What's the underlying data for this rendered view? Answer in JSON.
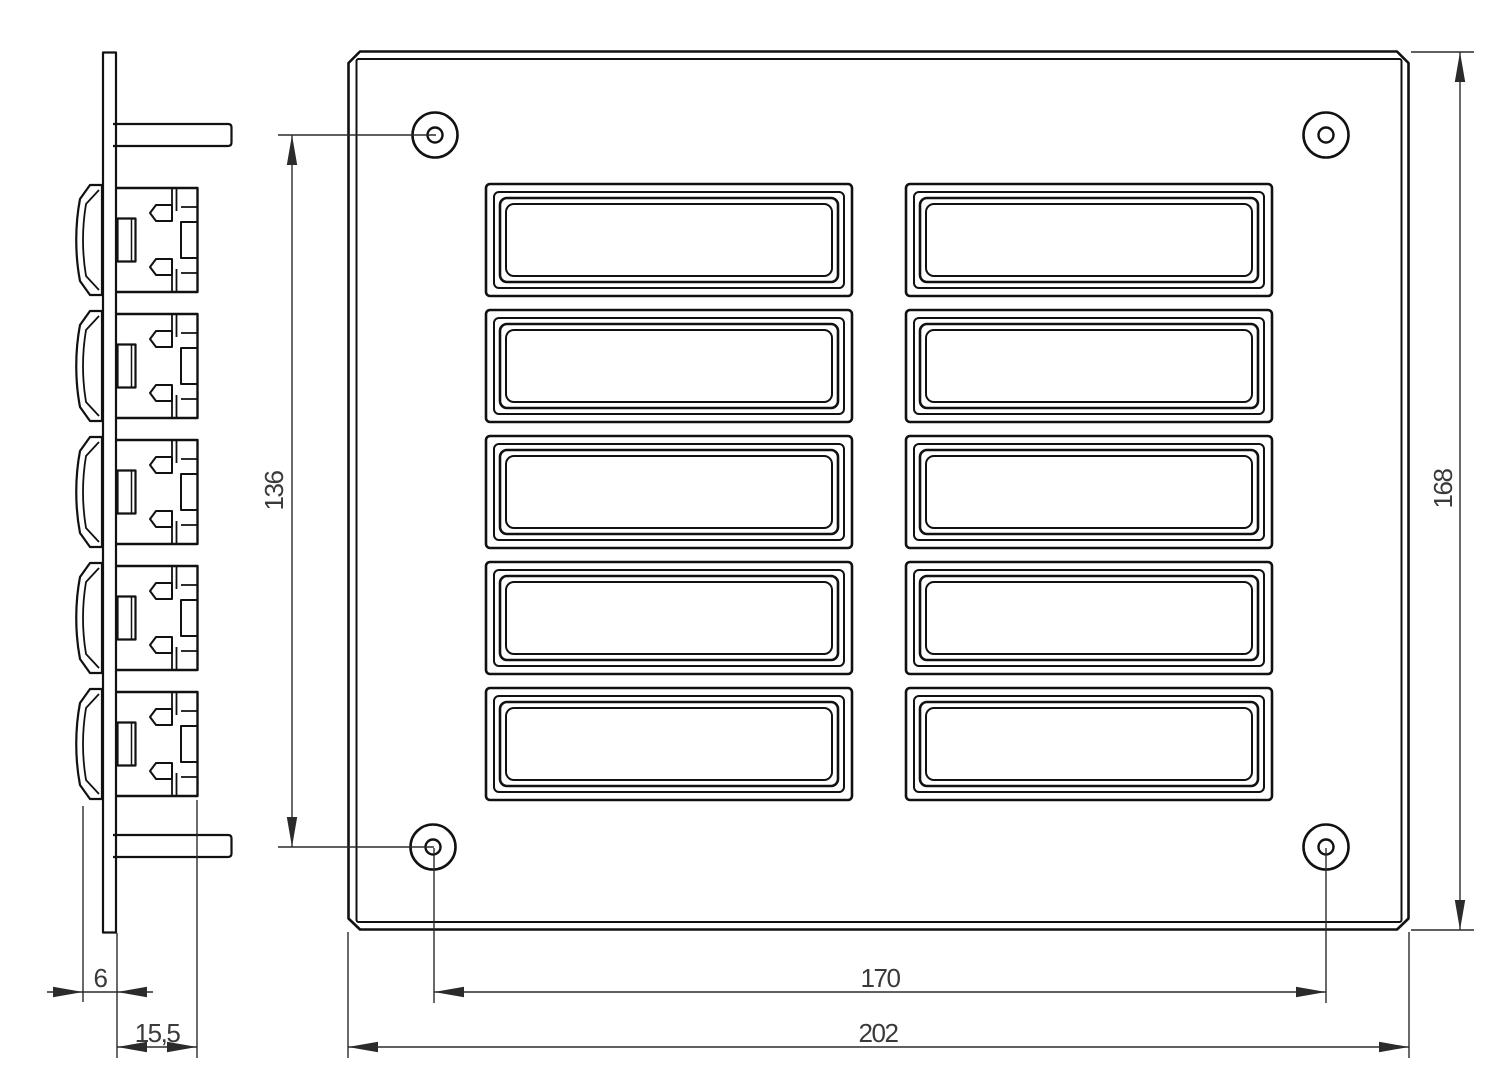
{
  "drawing": {
    "colors": {
      "line": "#111111",
      "dimension": "#2b2b2b",
      "text": "#3a3a3a",
      "background": "#ffffff"
    },
    "front_view": {
      "button_rows": 5,
      "button_columns": 2,
      "screw_holes": 4,
      "dimensions": {
        "hole_spacing_vertical": {
          "label": "136"
        },
        "overall_height": {
          "label": "168"
        },
        "hole_spacing_horizontal": {
          "label": "170"
        },
        "overall_width": {
          "label": "202"
        }
      }
    },
    "side_view": {
      "button_count": 5,
      "dimensions": {
        "front_thickness": {
          "label": "6"
        },
        "mounting_depth": {
          "label": "15,5"
        }
      }
    }
  }
}
